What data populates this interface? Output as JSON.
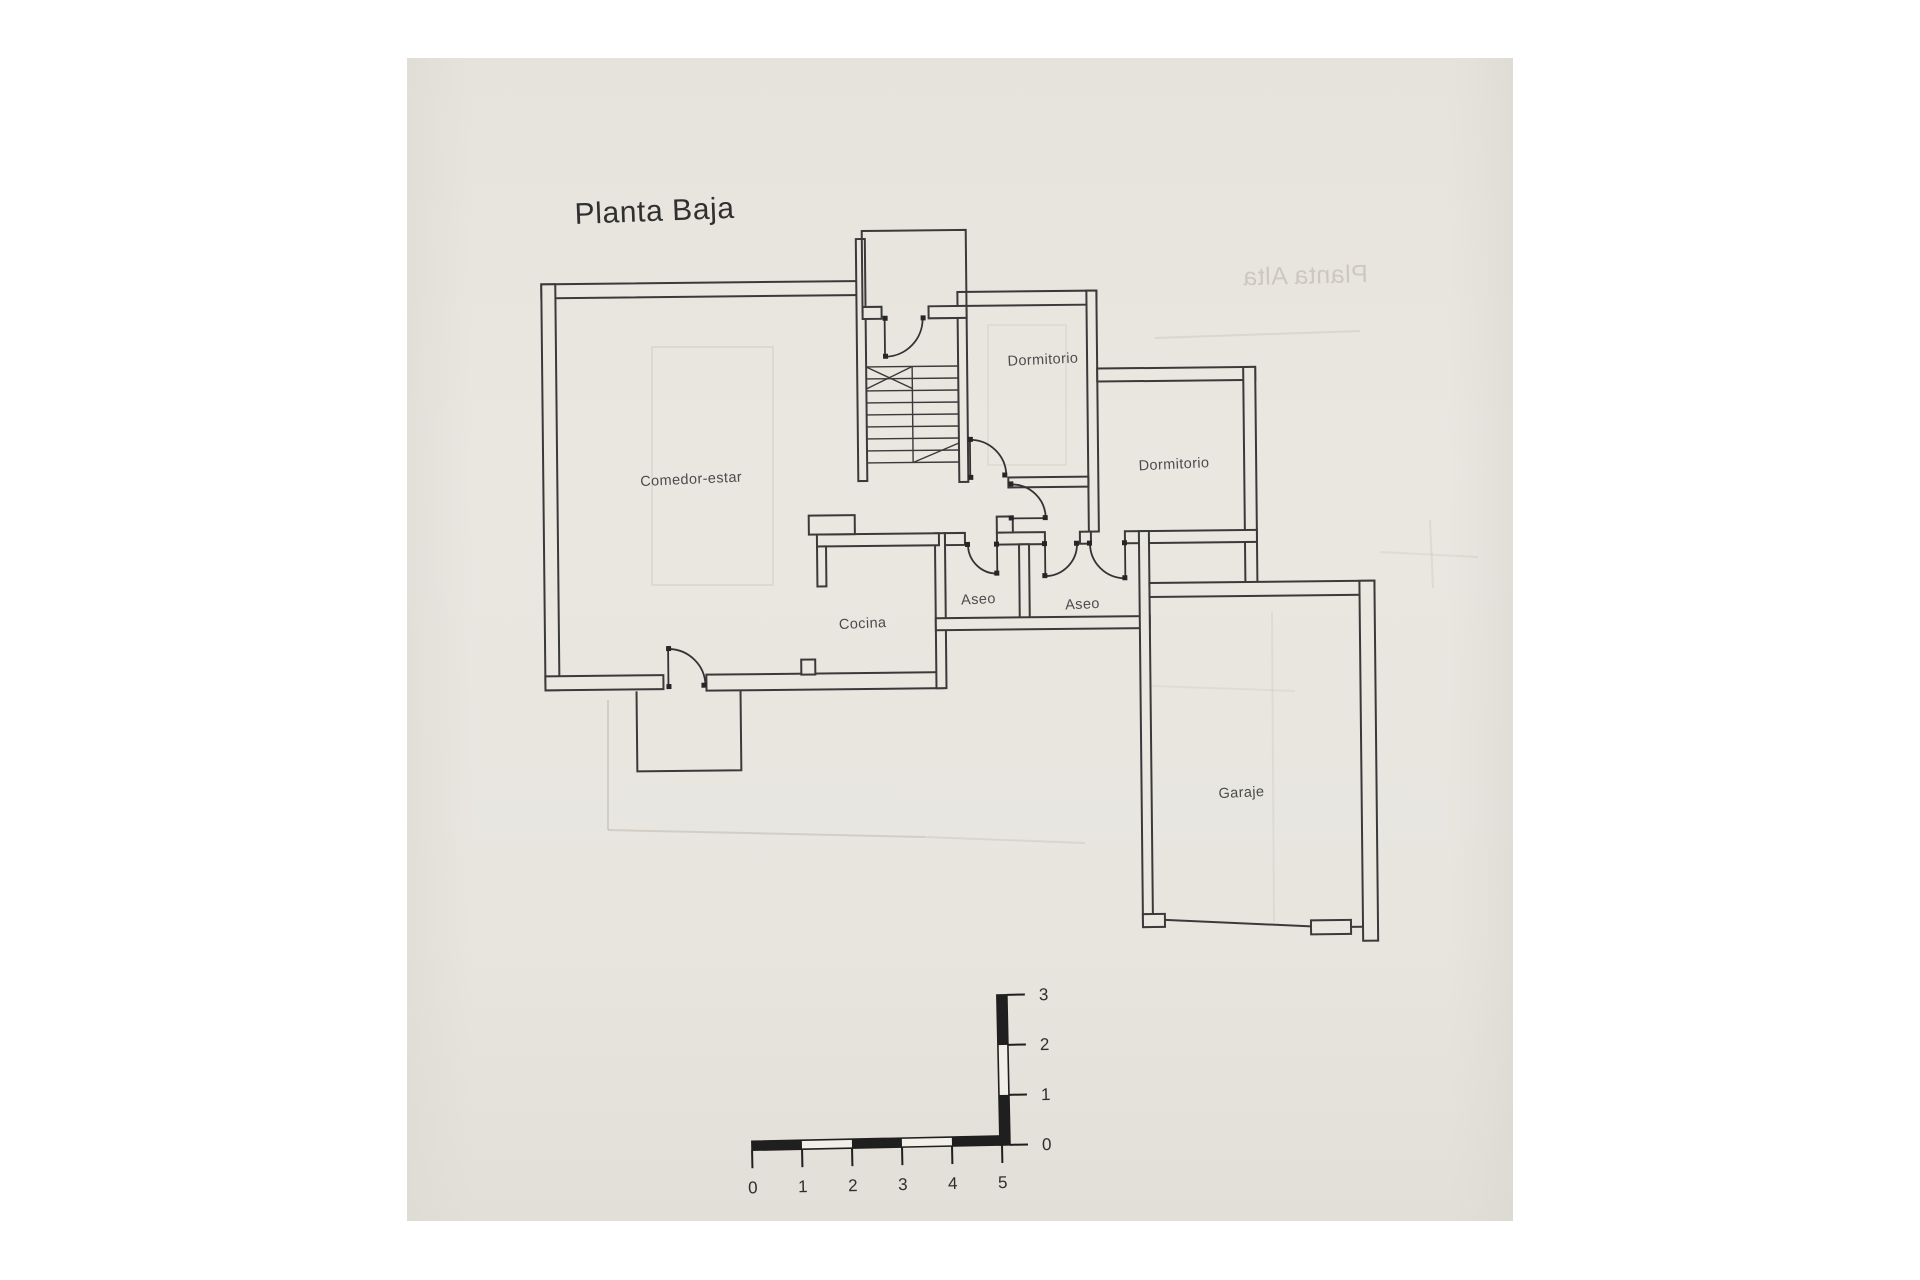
{
  "document": {
    "title": "Planta Baja",
    "ghost_bleed_title": "Planta Alta"
  },
  "rooms": [
    {
      "id": "comedor-estar",
      "label": "Comedor-estar"
    },
    {
      "id": "dormitorio-1",
      "label": "Dormitorio"
    },
    {
      "id": "dormitorio-2",
      "label": "Dormitorio"
    },
    {
      "id": "aseo-1",
      "label": "Aseo"
    },
    {
      "id": "aseo-2",
      "label": "Aseo"
    },
    {
      "id": "cocina",
      "label": "Cocina"
    },
    {
      "id": "garaje",
      "label": "Garaje"
    }
  ],
  "scale_bar": {
    "horizontal_labels": [
      "0",
      "1",
      "2",
      "3",
      "4",
      "5"
    ],
    "vertical_labels": [
      "3",
      "2",
      "1",
      "0"
    ]
  },
  "colors": {
    "background": "#ffffff",
    "paper": "#e9e6e0",
    "line": "#3a3a3a",
    "label": "#4c4c4c",
    "ghost": "#9a9183",
    "scale_black": "#1f1f1f"
  }
}
